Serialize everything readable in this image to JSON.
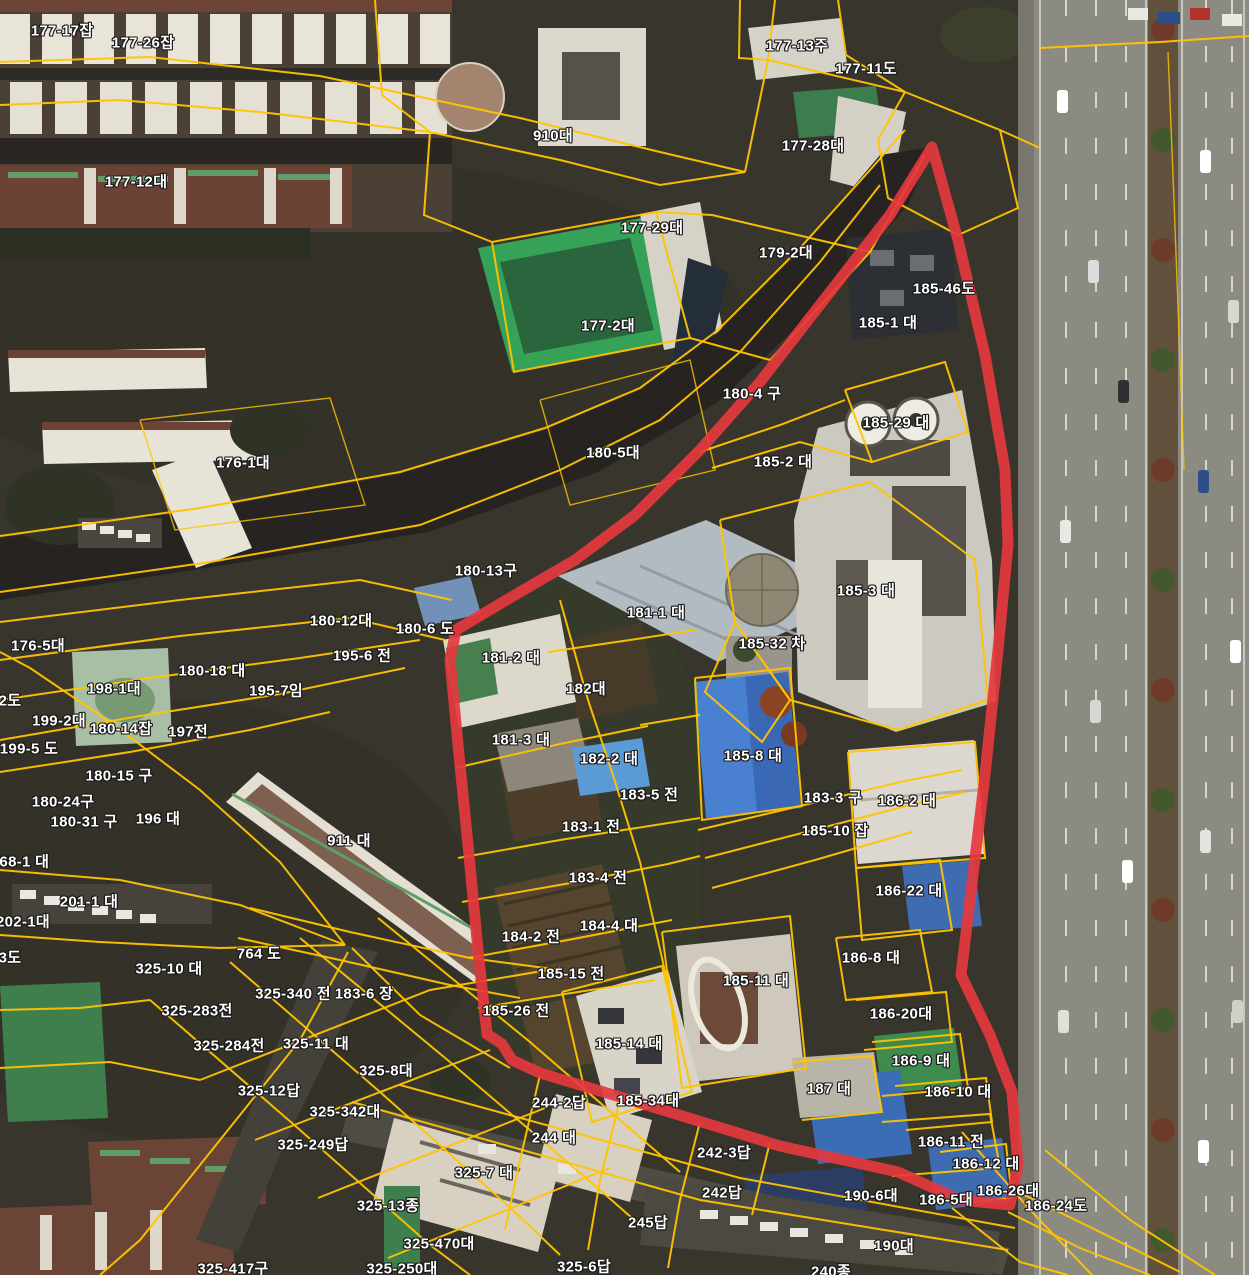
{
  "map": {
    "type": "cadastral-aerial-map",
    "colors": {
      "boundary_red": "#e5383d",
      "parcel_yellow": "#ffc400",
      "label_text": "#ffffff",
      "label_outline": "#171717"
    },
    "labels": [
      {
        "t": "177-17잡",
        "x": 62,
        "y": 30
      },
      {
        "t": "177-26잡",
        "x": 143,
        "y": 42
      },
      {
        "t": "177-13주",
        "x": 797,
        "y": 45
      },
      {
        "t": "177-11도",
        "x": 866,
        "y": 68
      },
      {
        "t": "910대",
        "x": 553,
        "y": 135
      },
      {
        "t": "177-28대",
        "x": 813,
        "y": 145
      },
      {
        "t": "177-12대",
        "x": 136,
        "y": 181
      },
      {
        "t": "177-29대",
        "x": 652,
        "y": 227
      },
      {
        "t": "179-2대",
        "x": 786,
        "y": 252
      },
      {
        "t": "185-46도",
        "x": 944,
        "y": 288
      },
      {
        "t": "185-1 대",
        "x": 888,
        "y": 322
      },
      {
        "t": "177-2대",
        "x": 608,
        "y": 325
      },
      {
        "t": "180-4 구",
        "x": 752,
        "y": 393
      },
      {
        "t": "185-29 대",
        "x": 896,
        "y": 422
      },
      {
        "t": "180-5대",
        "x": 613,
        "y": 452
      },
      {
        "t": "176-1대",
        "x": 243,
        "y": 462
      },
      {
        "t": "185-2 대",
        "x": 783,
        "y": 461
      },
      {
        "t": "180-13구",
        "x": 486,
        "y": 570
      },
      {
        "t": "185-3 대",
        "x": 866,
        "y": 590
      },
      {
        "t": "181-1 대",
        "x": 656,
        "y": 612
      },
      {
        "t": "180-12대",
        "x": 341,
        "y": 620
      },
      {
        "t": "180-6 도",
        "x": 425,
        "y": 628
      },
      {
        "t": "176-5대",
        "x": 38,
        "y": 645
      },
      {
        "t": "185-32 차",
        "x": 772,
        "y": 643
      },
      {
        "t": "195-6 전",
        "x": 362,
        "y": 655
      },
      {
        "t": "181-2 대",
        "x": 511,
        "y": 657
      },
      {
        "t": "180-18 대",
        "x": 212,
        "y": 670
      },
      {
        "t": "198-1대",
        "x": 114,
        "y": 688
      },
      {
        "t": "195-7임",
        "x": 276,
        "y": 690
      },
      {
        "t": "182대",
        "x": 586,
        "y": 688
      },
      {
        "t": "2도",
        "x": 10,
        "y": 700
      },
      {
        "t": "199-2대",
        "x": 59,
        "y": 720
      },
      {
        "t": "180-14잡",
        "x": 121,
        "y": 728
      },
      {
        "t": "197전",
        "x": 188,
        "y": 731
      },
      {
        "t": "199-5 도",
        "x": 29,
        "y": 748
      },
      {
        "t": "181-3 대",
        "x": 521,
        "y": 739
      },
      {
        "t": "185-8 대",
        "x": 753,
        "y": 755
      },
      {
        "t": "182-2 대",
        "x": 609,
        "y": 758
      },
      {
        "t": "180-15 구",
        "x": 119,
        "y": 775
      },
      {
        "t": "183-5 전",
        "x": 649,
        "y": 794
      },
      {
        "t": "183-3 구",
        "x": 833,
        "y": 797
      },
      {
        "t": "186-2 대",
        "x": 907,
        "y": 800
      },
      {
        "t": "180-24구",
        "x": 63,
        "y": 801
      },
      {
        "t": "196 대",
        "x": 158,
        "y": 818
      },
      {
        "t": "180-31 구",
        "x": 84,
        "y": 821
      },
      {
        "t": "183-1 전",
        "x": 591,
        "y": 826
      },
      {
        "t": "185-10 잡",
        "x": 835,
        "y": 830
      },
      {
        "t": "911 대",
        "x": 349,
        "y": 840
      },
      {
        "t": "768-1 대",
        "x": 20,
        "y": 861
      },
      {
        "t": "183-4 전",
        "x": 598,
        "y": 877
      },
      {
        "t": "186-22 대",
        "x": 909,
        "y": 890
      },
      {
        "t": "201-1 대",
        "x": 89,
        "y": 901
      },
      {
        "t": "202-1대",
        "x": 23,
        "y": 921
      },
      {
        "t": "184-4 대",
        "x": 609,
        "y": 925
      },
      {
        "t": "184-2 전",
        "x": 531,
        "y": 936
      },
      {
        "t": "764 도",
        "x": 259,
        "y": 953
      },
      {
        "t": "3도",
        "x": 10,
        "y": 957
      },
      {
        "t": "186-8 대",
        "x": 871,
        "y": 957
      },
      {
        "t": "325-10 대",
        "x": 169,
        "y": 968
      },
      {
        "t": "185-15 전",
        "x": 571,
        "y": 973
      },
      {
        "t": "185-11 대",
        "x": 756,
        "y": 980
      },
      {
        "t": "325-340 전",
        "x": 293,
        "y": 993
      },
      {
        "t": "183-6 장",
        "x": 364,
        "y": 993
      },
      {
        "t": "325-283전",
        "x": 197,
        "y": 1010
      },
      {
        "t": "185-26 전",
        "x": 516,
        "y": 1010
      },
      {
        "t": "186-20대",
        "x": 901,
        "y": 1013
      },
      {
        "t": "325-11 대",
        "x": 316,
        "y": 1043
      },
      {
        "t": "185-14 대",
        "x": 629,
        "y": 1043
      },
      {
        "t": "325-284전",
        "x": 229,
        "y": 1045
      },
      {
        "t": "186-9 대",
        "x": 921,
        "y": 1060
      },
      {
        "t": "325-8대",
        "x": 386,
        "y": 1070
      },
      {
        "t": "325-12답",
        "x": 269,
        "y": 1090
      },
      {
        "t": "187 대",
        "x": 829,
        "y": 1088
      },
      {
        "t": "186-10 대",
        "x": 958,
        "y": 1091
      },
      {
        "t": "185-34대",
        "x": 648,
        "y": 1100
      },
      {
        "t": "244-2답",
        "x": 559,
        "y": 1102
      },
      {
        "t": "325-342대",
        "x": 345,
        "y": 1111
      },
      {
        "t": "244 대",
        "x": 554,
        "y": 1137
      },
      {
        "t": "186-11 전",
        "x": 951,
        "y": 1141
      },
      {
        "t": "325-249답",
        "x": 313,
        "y": 1144
      },
      {
        "t": "242-3답",
        "x": 724,
        "y": 1152
      },
      {
        "t": "186-12 대",
        "x": 986,
        "y": 1163
      },
      {
        "t": "325-7 대",
        "x": 484,
        "y": 1172
      },
      {
        "t": "186-26대",
        "x": 1008,
        "y": 1190
      },
      {
        "t": "242답",
        "x": 722,
        "y": 1192
      },
      {
        "t": "190-6대",
        "x": 871,
        "y": 1195
      },
      {
        "t": "186-5대",
        "x": 946,
        "y": 1199
      },
      {
        "t": "325-13종",
        "x": 388,
        "y": 1205
      },
      {
        "t": "186-24도",
        "x": 1056,
        "y": 1205
      },
      {
        "t": "245답",
        "x": 648,
        "y": 1222
      },
      {
        "t": "190대",
        "x": 894,
        "y": 1245
      },
      {
        "t": "325-470대",
        "x": 439,
        "y": 1243
      },
      {
        "t": "325-417구",
        "x": 233,
        "y": 1268
      },
      {
        "t": "325-250대",
        "x": 402,
        "y": 1268
      },
      {
        "t": "325-6답",
        "x": 584,
        "y": 1266
      },
      {
        "t": "240종",
        "x": 831,
        "y": 1271
      }
    ]
  }
}
